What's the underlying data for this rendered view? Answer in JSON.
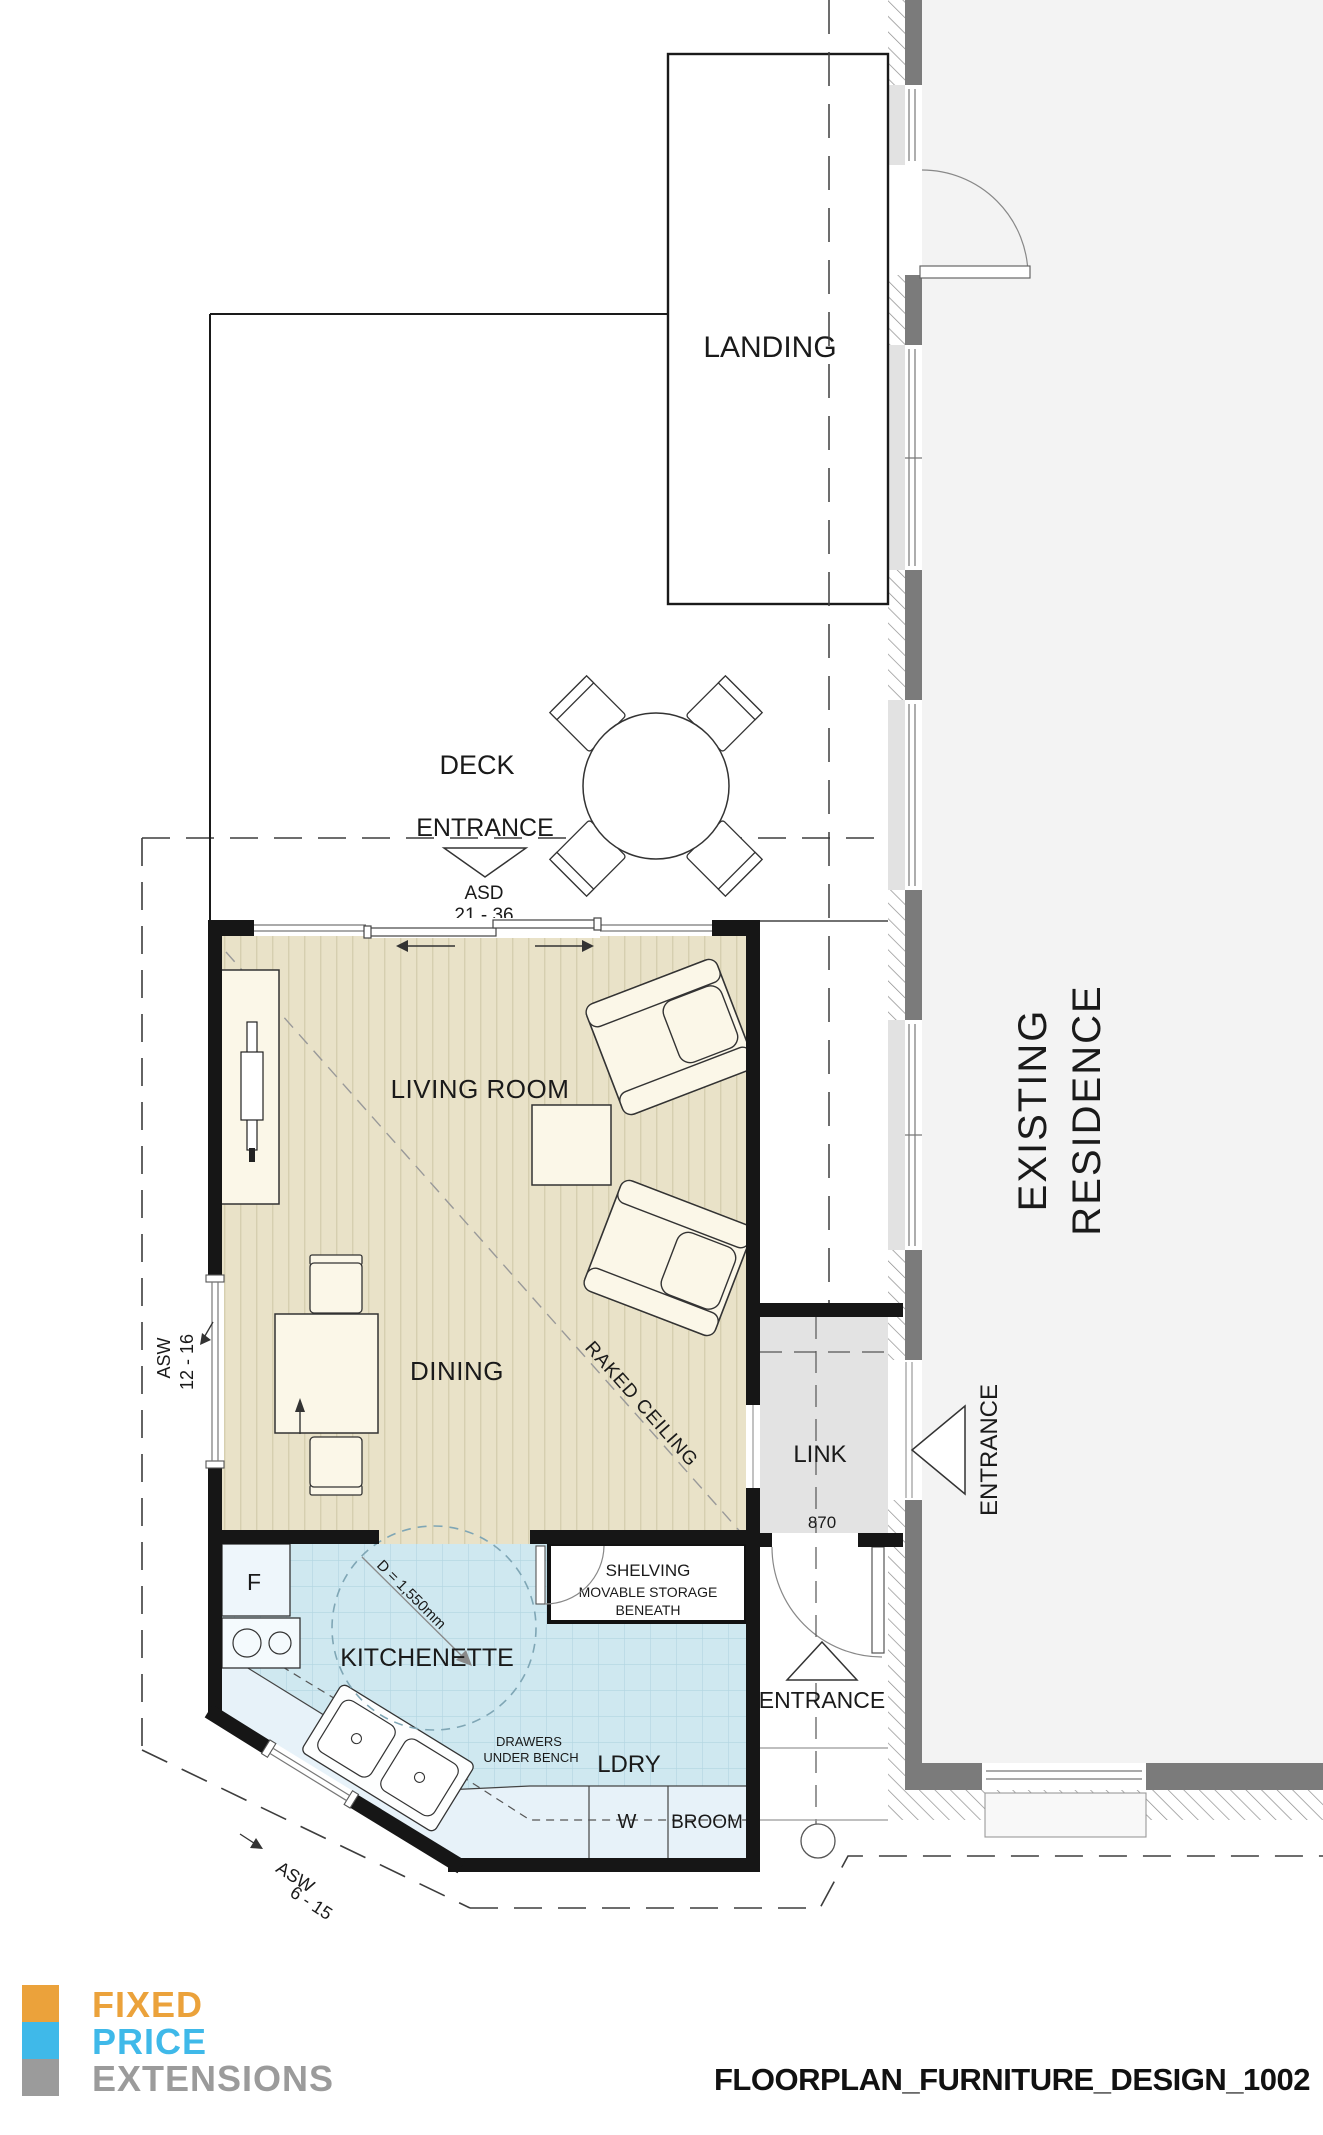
{
  "plan": {
    "rooms": {
      "landing": "LANDING",
      "deck": "DECK",
      "living": "LIVING ROOM",
      "dining": "DINING",
      "kitchenette": "KITCHENETTE",
      "link": "LINK",
      "ldry": "LDRY",
      "existing_line1": "EXISTING",
      "existing_line2": "RESIDENCE"
    },
    "labels": {
      "deck_entrance": "ENTRANCE",
      "asd": "ASD",
      "asd_range": "21 - 36",
      "asw_left": "ASW",
      "asw_left_range": "12 - 16",
      "asw_angled": "ASW",
      "asw_angled_range": "6 - 15",
      "raked_ceiling": "RAKED CEILING",
      "turning_circle": "D = 1,550mm",
      "fridge": "F",
      "shelving_line1": "SHELVING",
      "shelving_line2": "MOVABLE STORAGE",
      "shelving_line3": "BENEATH",
      "drawers_line1": "DRAWERS",
      "drawers_line2": "UNDER BENCH",
      "washer": "W",
      "broom": "BROOM",
      "link_door_width": "870",
      "rear_entrance": "ENTRANCE",
      "residence_entrance": "ENTRANCE"
    }
  },
  "footer": {
    "logo": {
      "line1": "FIXED",
      "line2": "PRICE",
      "line3": "EXTENSIONS",
      "orange": "#EBA23B",
      "blue": "#3FB9E9",
      "gray": "#9B9B9B"
    },
    "title": "FLOORPLAN_FURNITURE_DESIGN_1002"
  }
}
